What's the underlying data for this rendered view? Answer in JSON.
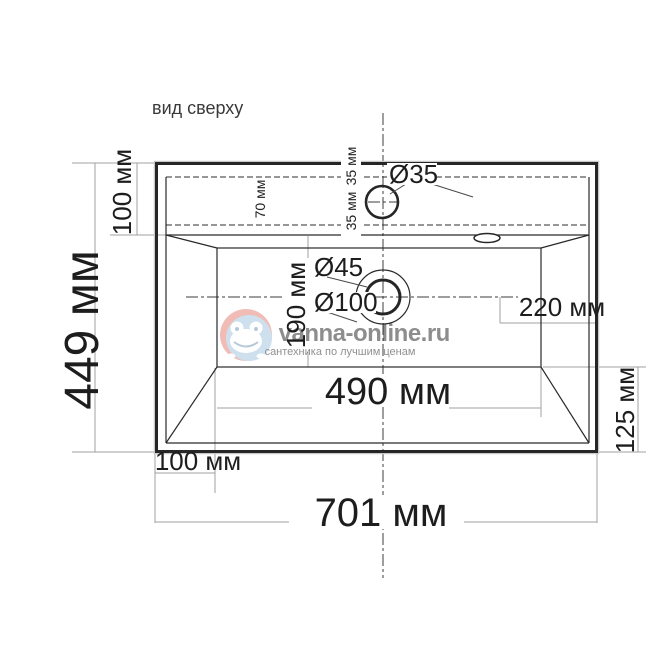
{
  "title": "вид сверху",
  "dims": {
    "overall_height": "449 мм",
    "deck_depth": "100 мм",
    "deck_hidden": "70 мм",
    "faucet_offset_up": "35 мм",
    "faucet_offset_down": "35 мм",
    "faucet_hole_diameter": "Ø35",
    "drain_inner_diameter": "Ø45",
    "drain_outer_diameter": "Ø100",
    "bowl_depth": "190 мм",
    "drain_to_right": "220 мм",
    "bowl_width": "490 мм",
    "right_margin": "125 мм",
    "left_offset": "100 мм",
    "overall_width": "701 мм"
  },
  "watermark": {
    "brand_left": "vanna-",
    "brand_right": "online.ru",
    "tagline": "сантехника по лучшим ценам",
    "colors": {
      "brand_blue": "#96b1cc",
      "brand_red": "#d95f52",
      "tagline_blue": "#9fbdd4",
      "logo_red": "#e4796f",
      "logo_blue": "#9fc2dc"
    }
  },
  "colors": {
    "drawing_line": "#262626",
    "dimension_line": "#a0a0a0",
    "center_line": "#3d3d3d"
  }
}
